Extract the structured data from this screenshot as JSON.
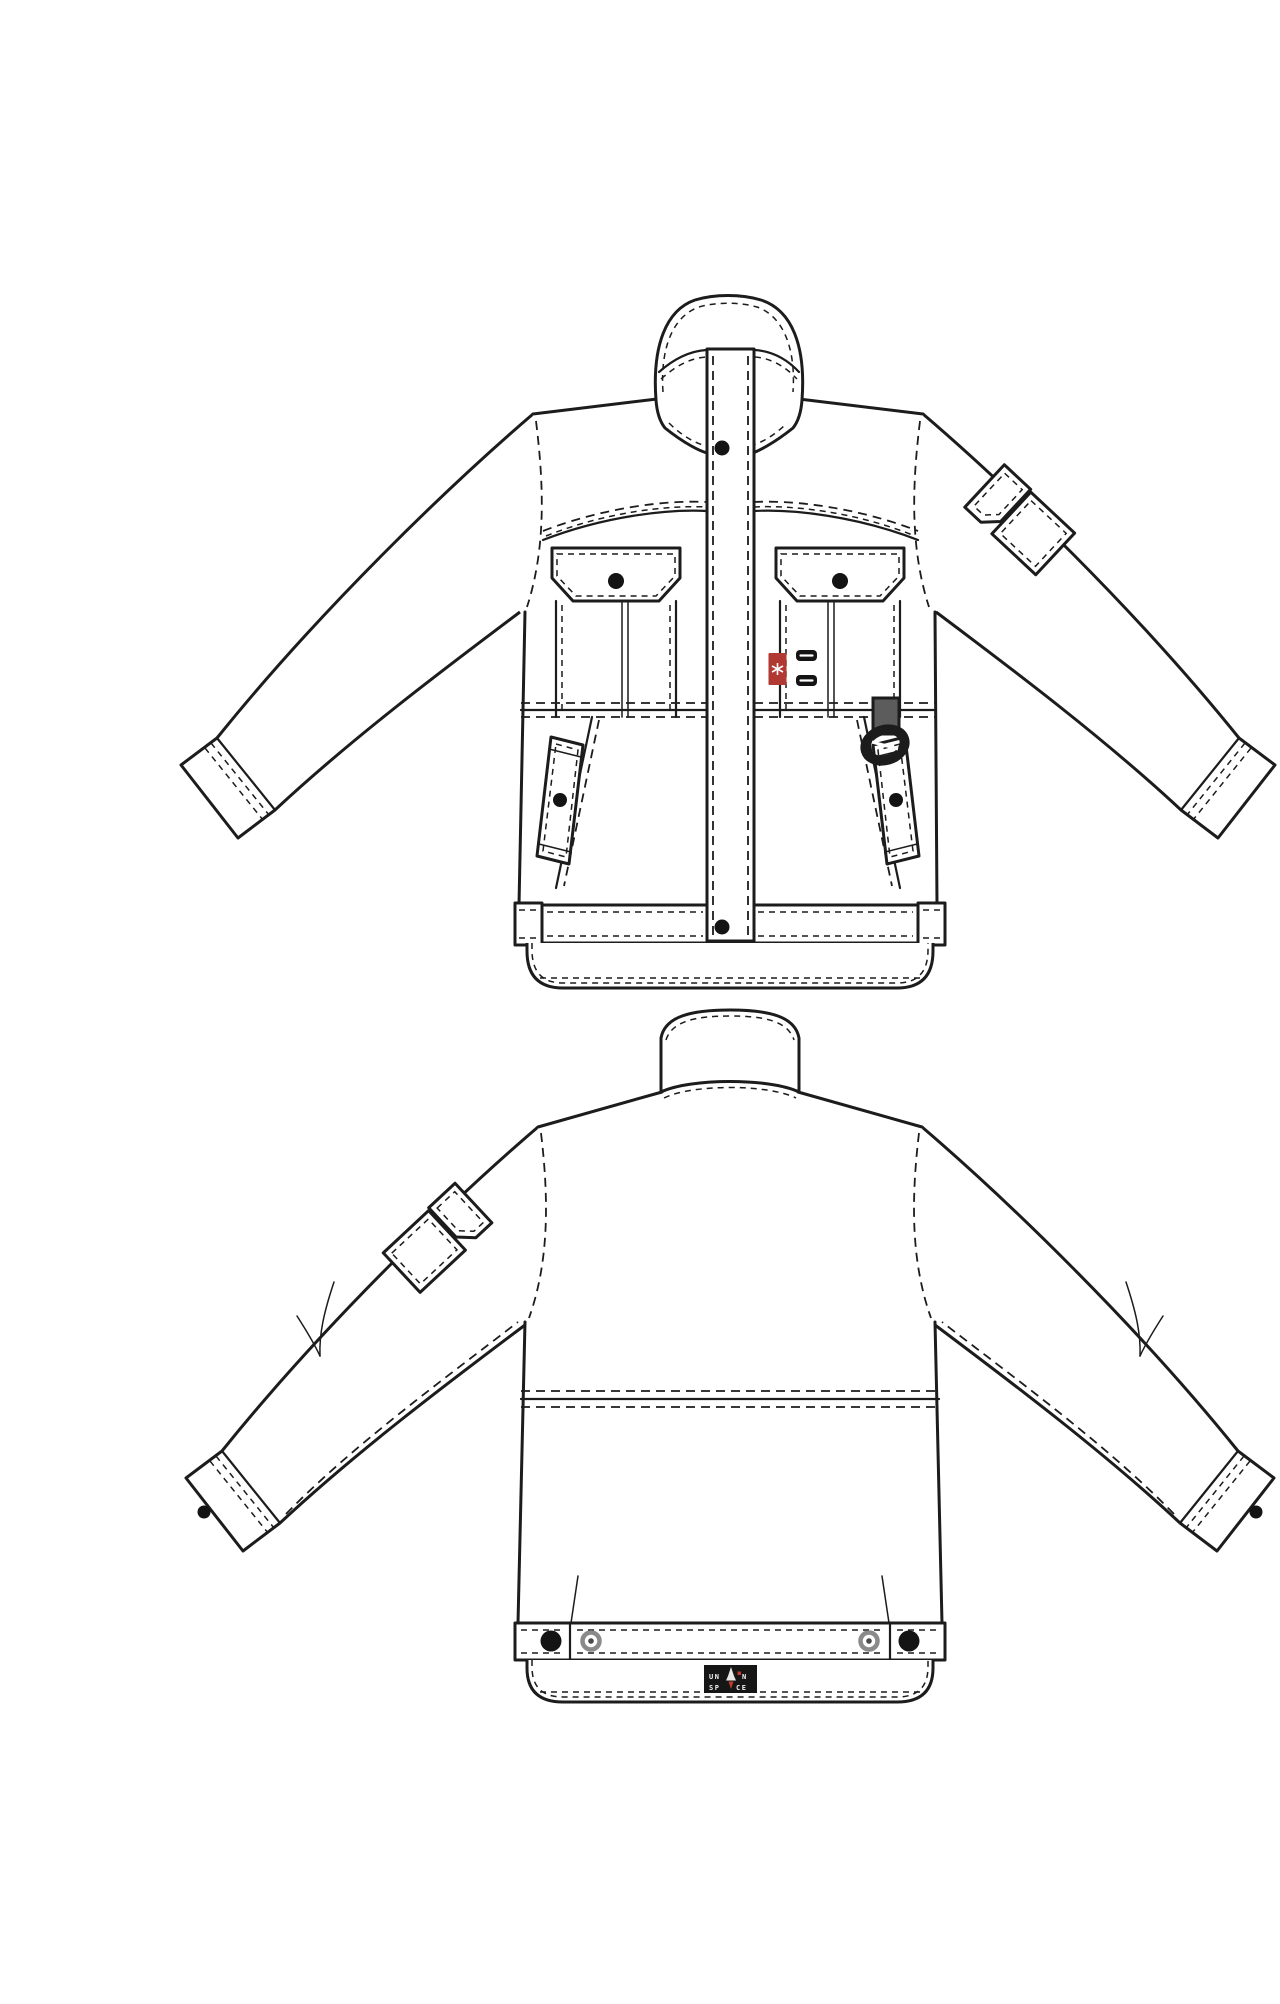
{
  "document": {
    "type": "technical-flat-sketch",
    "garment": "utility work jacket",
    "views": [
      {
        "id": "front",
        "name": "jacket-front-view"
      },
      {
        "id": "back",
        "name": "jacket-back-view"
      }
    ]
  },
  "colors": {
    "background": "#ffffff",
    "line": "#1c1c1c",
    "snap": "#141414",
    "red_tag": "#b03a32",
    "label_bg": "#161616",
    "label_text": "#f2f2f2",
    "label_accent": "#c2392e",
    "webbing": "#5c5c5c",
    "ring_snap_outer": "#8a8a8a",
    "ring_snap_center": "#4a4a4a"
  },
  "brand_label": {
    "line1_left": "UN",
    "line1_right": "N",
    "line2_left": "SP",
    "line2_right": "CE",
    "icon": "rocket-icon"
  },
  "front_view": {
    "parts": [
      "stand-collar",
      "center-front-placket",
      "snap-buttons",
      "chest-flap-pockets",
      "bellows-pleats",
      "red-brand-tab",
      "webbing-bartacks",
      "d-ring-hanger",
      "waist-seam",
      "slanted-welt-pockets",
      "waistband-with-tabs",
      "hem-skirt",
      "sleeve-flap-pocket",
      "cuffs"
    ]
  },
  "back_view": {
    "parts": [
      "stand-collar",
      "shoulder-seams",
      "sleeve-flap-pocket",
      "elbow-darts",
      "waist-seam",
      "back-waistband",
      "snap-buttons",
      "rivet-snaps",
      "hem-skirt",
      "brand-label",
      "cuff-snaps"
    ]
  }
}
